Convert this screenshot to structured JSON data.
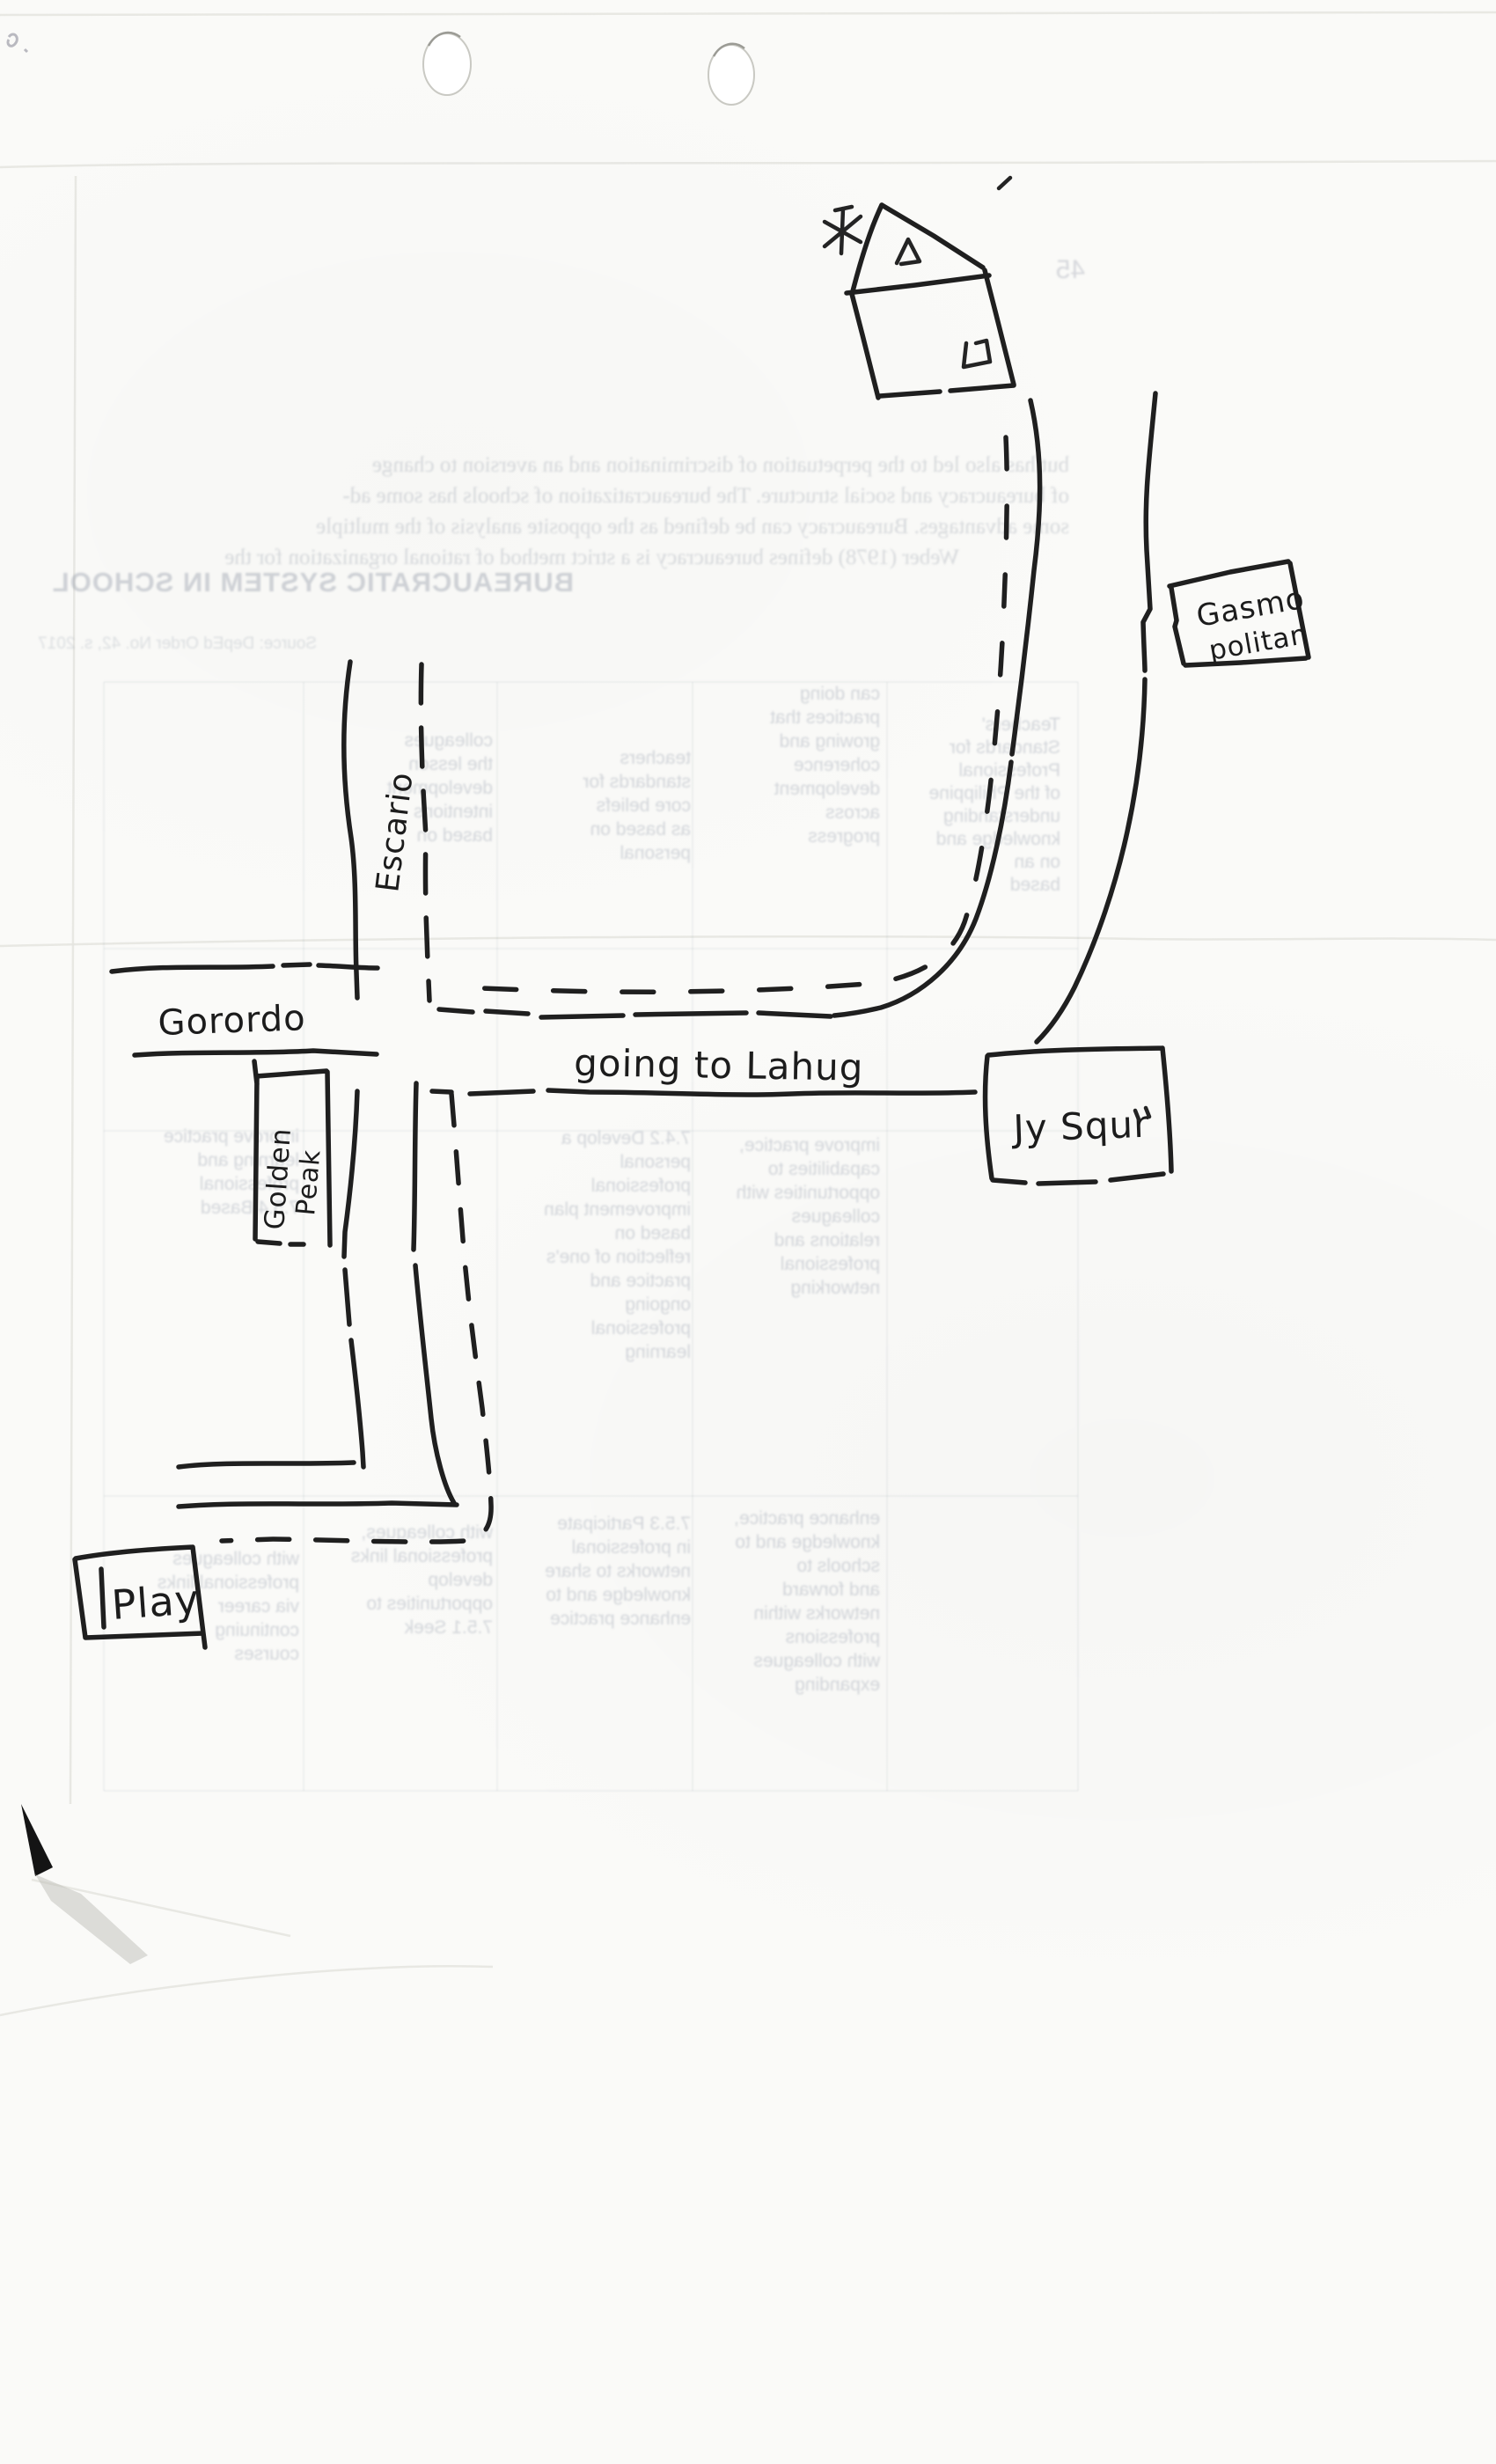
{
  "map_labels": {
    "escario": "Escario",
    "gorordo": "Gorordo",
    "going_to_lahug": "going to Lahug",
    "gasmo_line1": "Gasmo",
    "gasmo_line2": "politan",
    "jy_square": "Jy Squr",
    "golden_line1": "Golden",
    "golden_line2": "Peak",
    "play": "Play"
  },
  "bleed_through": {
    "heading": "BUREAUCRATIC SYSTEM IN SCHOOL",
    "paragraph": [
      "but has also led to the perpetuation of discrimination and an aversion to change",
      "of bureaucracy and social structure. The bureaucratization of schools has some ad-",
      "some advantages. Bureaucracy can be defined as the opposite analysis of the multiple",
      "Weber (1978) defines bureaucracy is a strict method of rational organization for the"
    ],
    "source": "Source: DepEd Order No. 42, s. 2017",
    "page_mark": "45",
    "cells": {
      "c5r1": [
        "Teachers'",
        "Standards for",
        "Professional",
        "of the Philippine",
        "understanding",
        "knowledge and",
        "on an",
        "based"
      ],
      "c4r1": [
        "can doing",
        "practices that",
        "growing and",
        "coherence",
        "development",
        "across",
        "progress"
      ],
      "c3r1": [
        "teachers",
        "standards for",
        "core beliefs",
        "as based on",
        "personal"
      ],
      "c2r1": [
        "colleagues",
        "the lesson",
        "development",
        "intentions",
        "based on"
      ],
      "c1r3": [
        "improve practice",
        "learning and",
        "professional",
        "7.5.4 Based"
      ],
      "c3r3": [
        "7.4.2 Develop a",
        "personal",
        "professional",
        "improvement plan",
        "based on",
        "reflection of one's",
        "practice and",
        "ongoing",
        "professional",
        "learning"
      ],
      "c4r3": [
        "improve practice,",
        "capabilities to",
        "opportunities with",
        "colleagues",
        "relations and",
        "professional",
        "networking"
      ],
      "c3r4": [
        "7.5.3 Participate",
        "in professional",
        "networks to share",
        "knowledge and to",
        "enhance practice"
      ],
      "c4r4": [
        "enhance practice,",
        "knowledge and to",
        "schools to",
        "and forward",
        "networks within",
        "professions",
        "with colleagues",
        "expanding"
      ],
      "c2r4": [
        "with colleagues,",
        "professional links",
        "develop",
        "opportunities to",
        "7.5.1 Seek"
      ],
      "c1r4": [
        "with colleagues",
        "professional links",
        "via career",
        "continuing",
        "courses"
      ]
    }
  },
  "colors": {
    "ink": "#1f1f1f",
    "paper": "#fafaf8",
    "bleed_text": "#8b93a3",
    "crease": "#e4e4df",
    "corner_blot": "#111111"
  }
}
